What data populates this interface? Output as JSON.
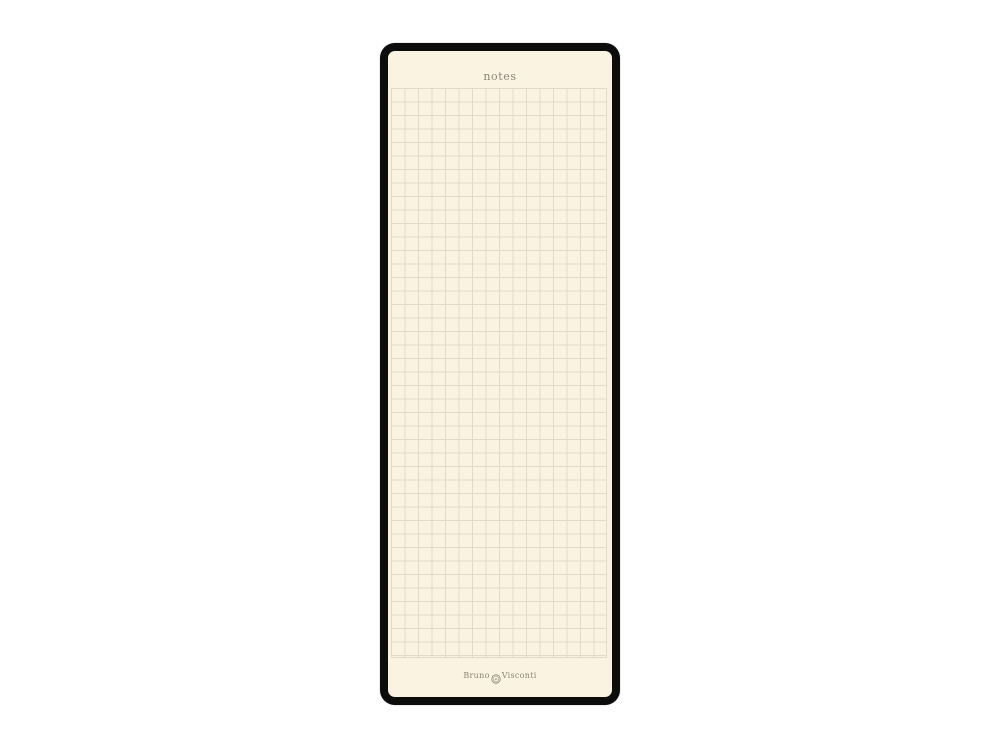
{
  "product_image": {
    "description": "black notepad with cream squared notes page",
    "page": {
      "header_label": "notes"
    },
    "brand": {
      "name_left": "Bruno",
      "name_right": "Visconti",
      "emblem": "bv-monogram-circle"
    },
    "colors": {
      "canvas_background": "#ffffff",
      "cover_black": "#0c0c0b",
      "paper_cream": "#faf3e2",
      "grid_line": "#e0dbc9",
      "ink_gray": "#8b8476"
    }
  }
}
